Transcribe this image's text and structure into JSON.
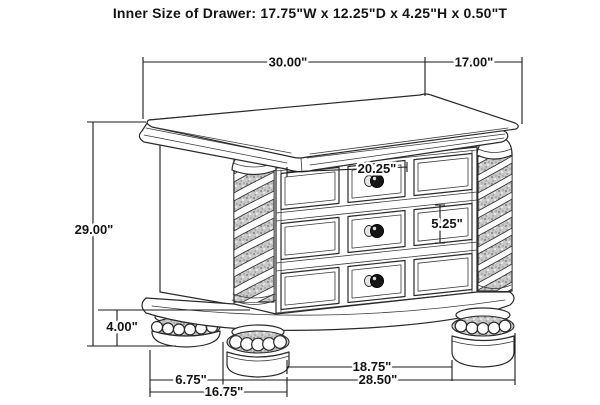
{
  "title": "Inner Size of Drawer: 17.75\"W x 12.25\"D x 4.25\"H x 0.50\"T",
  "colors": {
    "background": "#ffffff",
    "line": "#2a2a2a",
    "dimension_line": "#1a1a1a",
    "text": "#141414",
    "knob": "#151515",
    "column_carving": "#c9c9c9"
  },
  "dims": {
    "overall_width": "30.00\"",
    "overall_depth": "17.00\"",
    "overall_height": "29.00\"",
    "foot_height": "4.00\"",
    "drawer_front_width": "20.25\"",
    "drawer_front_height": "5.25\"",
    "front_feet_gap": "18.75\"",
    "foot_width": "6.75\"",
    "feet_outer_span": "28.50\"",
    "left_feet_span": "16.75\""
  }
}
